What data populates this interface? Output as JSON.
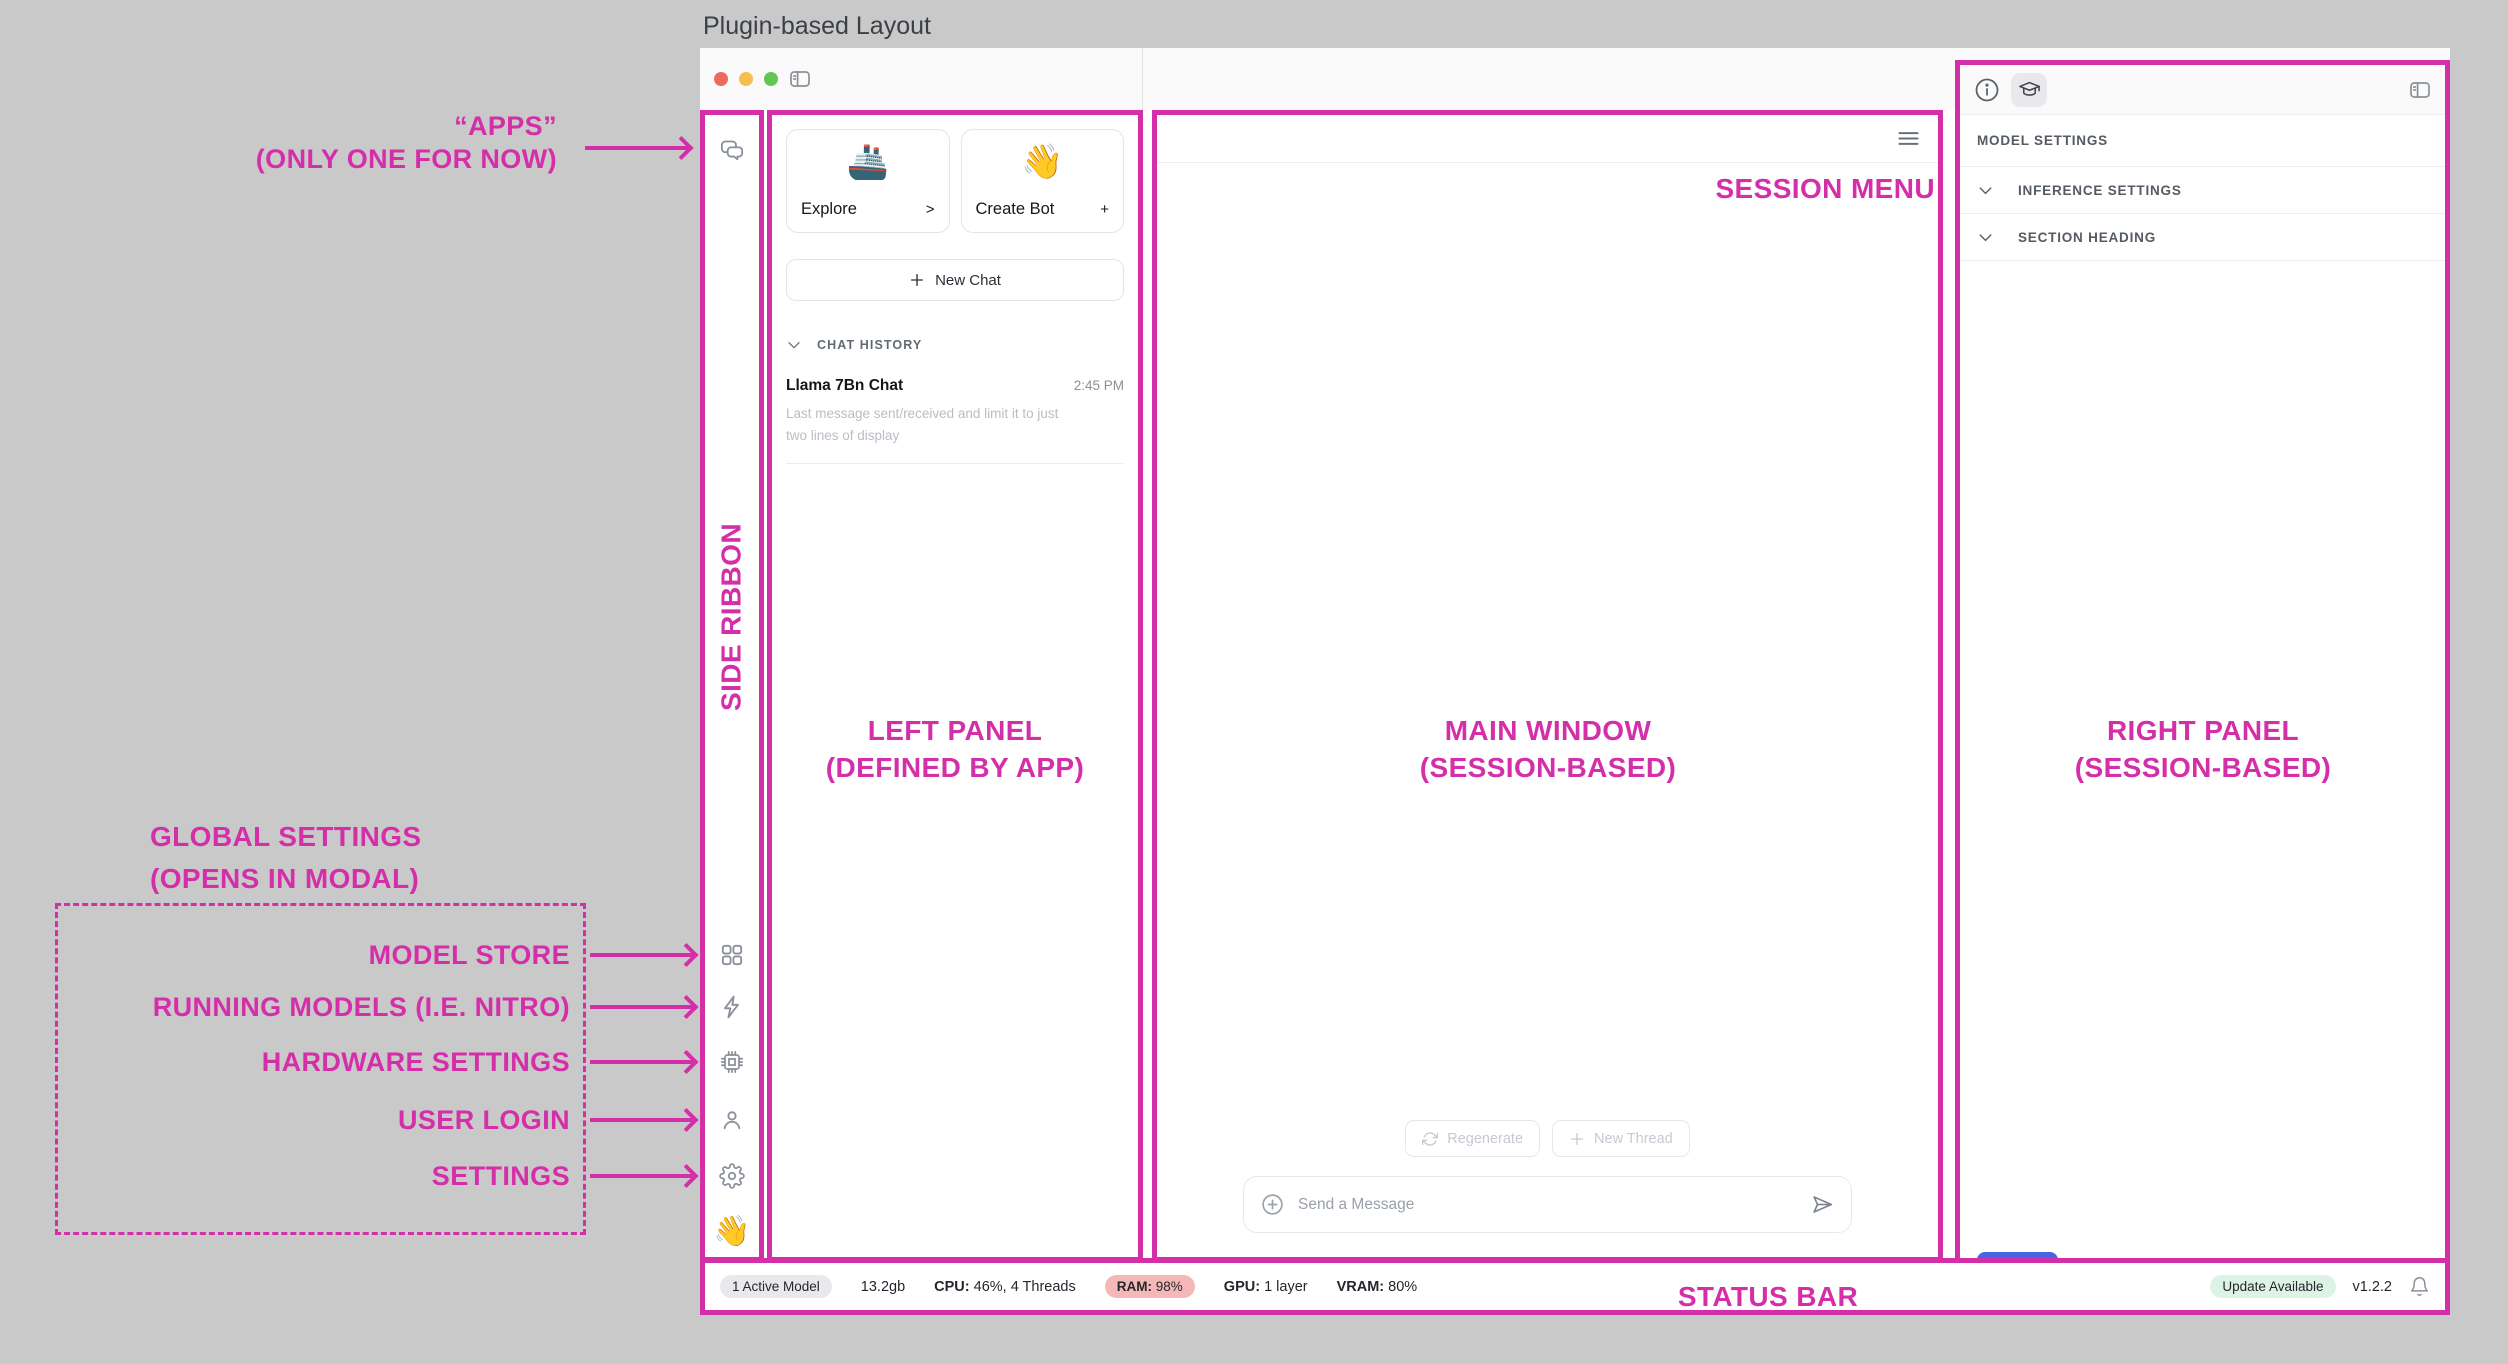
{
  "page_title": "Plugin-based Layout",
  "colors": {
    "accent_pink": "#D42EA9",
    "save_button_blue": "#4565E4",
    "ram_badge_bg": "#F4B9B6",
    "update_badge_bg": "#DDF3E6",
    "active_badge_bg": "#E9E9EC"
  },
  "annotations": {
    "apps_line1": "“APPS”",
    "apps_line2": "(ONLY ONE FOR NOW)",
    "side_ribbon": "SIDE RIBBON",
    "left_panel_line1": "LEFT PANEL",
    "left_panel_line2": "(DEFINED BY APP)",
    "main_window_line1": "MAIN WINDOW",
    "main_window_line2": "(SESSION-BASED)",
    "right_panel_line1": "RIGHT PANEL",
    "right_panel_line2": "(SESSION-BASED)",
    "session_menu": "SESSION MENU",
    "global_settings_line1": "GLOBAL SETTINGS",
    "global_settings_line2": "(OPENS IN MODAL)",
    "modal_labels": [
      "MODEL STORE",
      "RUNNING MODELS (I.E. NITRO)",
      "HARDWARE SETTINGS",
      "USER LOGIN",
      "SETTINGS"
    ],
    "status_bar": "STATUS BAR"
  },
  "icons": {
    "topbar": [
      "traffic-light-close",
      "traffic-light-minimize",
      "traffic-light-zoom",
      "sidebar-toggle"
    ],
    "ribbon": [
      "chat-bubbles",
      "grid",
      "lightning",
      "chip",
      "user",
      "gear",
      "wave-emoji"
    ],
    "main": [
      "hamburger-menu",
      "refresh",
      "plus",
      "circle-plus",
      "send"
    ],
    "right_panel": [
      "info-circle",
      "graduation-cap",
      "sidebar-toggle",
      "chevron-down"
    ],
    "status": [
      "bell"
    ]
  },
  "left_panel": {
    "explore_card": {
      "emoji": "🚢",
      "label": "Explore",
      "affordance": ">"
    },
    "create_bot_card": {
      "emoji": "👋",
      "label": "Create Bot",
      "affordance": "+"
    },
    "new_chat_label": "New Chat",
    "chat_history_header": "CHAT HISTORY",
    "chat_item": {
      "title": "Llama 7Bn Chat",
      "time": "2:45 PM",
      "preview_line1": "Last message sent/received and limit it to just",
      "preview_line2": "two lines of display"
    }
  },
  "ribbon": {
    "bottom_emoji": "👋"
  },
  "main": {
    "regenerate_label": "Regenerate",
    "new_thread_label": "New Thread",
    "message_placeholder": "Send a Message"
  },
  "right_panel": {
    "model_settings": "MODEL SETTINGS",
    "inference_settings": "INFERENCE SETTINGS",
    "section_heading": "SECTION HEADING",
    "save_label": "Save"
  },
  "status": {
    "active_model": "1 Active Model",
    "memory": "13.2gb",
    "cpu_label": "CPU:",
    "cpu_value": "46%, 4 Threads",
    "ram_label": "RAM:",
    "ram_value": "98%",
    "gpu_label": "GPU:",
    "gpu_value": "1 layer",
    "vram_label": "VRAM:",
    "vram_value": "80%",
    "update_badge": "Update Available",
    "version": "v1.2.2"
  }
}
